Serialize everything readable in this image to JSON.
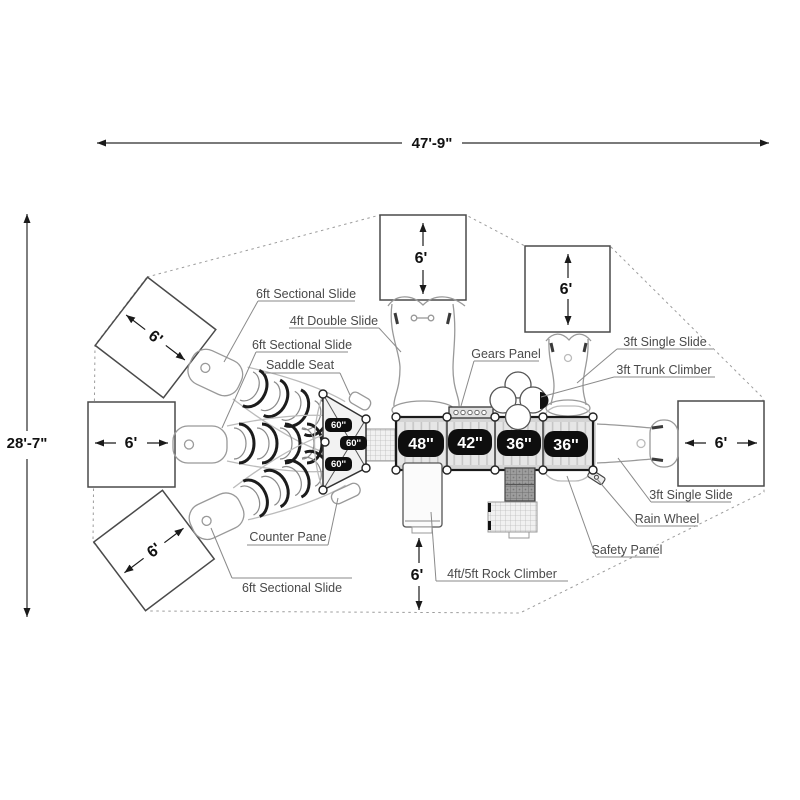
{
  "diagram_title": "playground-structure-top-view-plan",
  "dimensions": {
    "overall_width": "47'-9\"",
    "overall_height": "28'-7\""
  },
  "clearance_zones": {
    "top_left": "6'",
    "mid_left": "6'",
    "bottom_left": "6'",
    "top_center": "6'",
    "top_right": "6'",
    "right": "6'",
    "rock_climber": "6'"
  },
  "platforms": {
    "fan_deck_labels": [
      "60''",
      "60''",
      "60''"
    ],
    "deck_labels": [
      "48''",
      "42''",
      "36''",
      "36''"
    ]
  },
  "callouts": [
    {
      "id": "sectional-slide-top",
      "text": "6ft Sectional Slide"
    },
    {
      "id": "double-slide",
      "text": "4ft Double Slide"
    },
    {
      "id": "sectional-slide-mid",
      "text": "6ft Sectional Slide"
    },
    {
      "id": "saddle-seat",
      "text": "Saddle Seat"
    },
    {
      "id": "gears-panel",
      "text": "Gears Panel"
    },
    {
      "id": "single-slide-top-right",
      "text": "3ft Single Slide"
    },
    {
      "id": "trunk-climber",
      "text": "3ft Trunk Climber"
    },
    {
      "id": "counter-pane",
      "text": "Counter Pane"
    },
    {
      "id": "sectional-slide-bottom",
      "text": "6ft Sectional Slide"
    },
    {
      "id": "rock-climber",
      "text": "4ft/5ft Rock Climber"
    },
    {
      "id": "safety-panel",
      "text": "Safety Panel"
    },
    {
      "id": "rain-wheel",
      "text": "Rain Wheel"
    },
    {
      "id": "single-slide-bottom-right",
      "text": "3ft Single Slide"
    }
  ]
}
